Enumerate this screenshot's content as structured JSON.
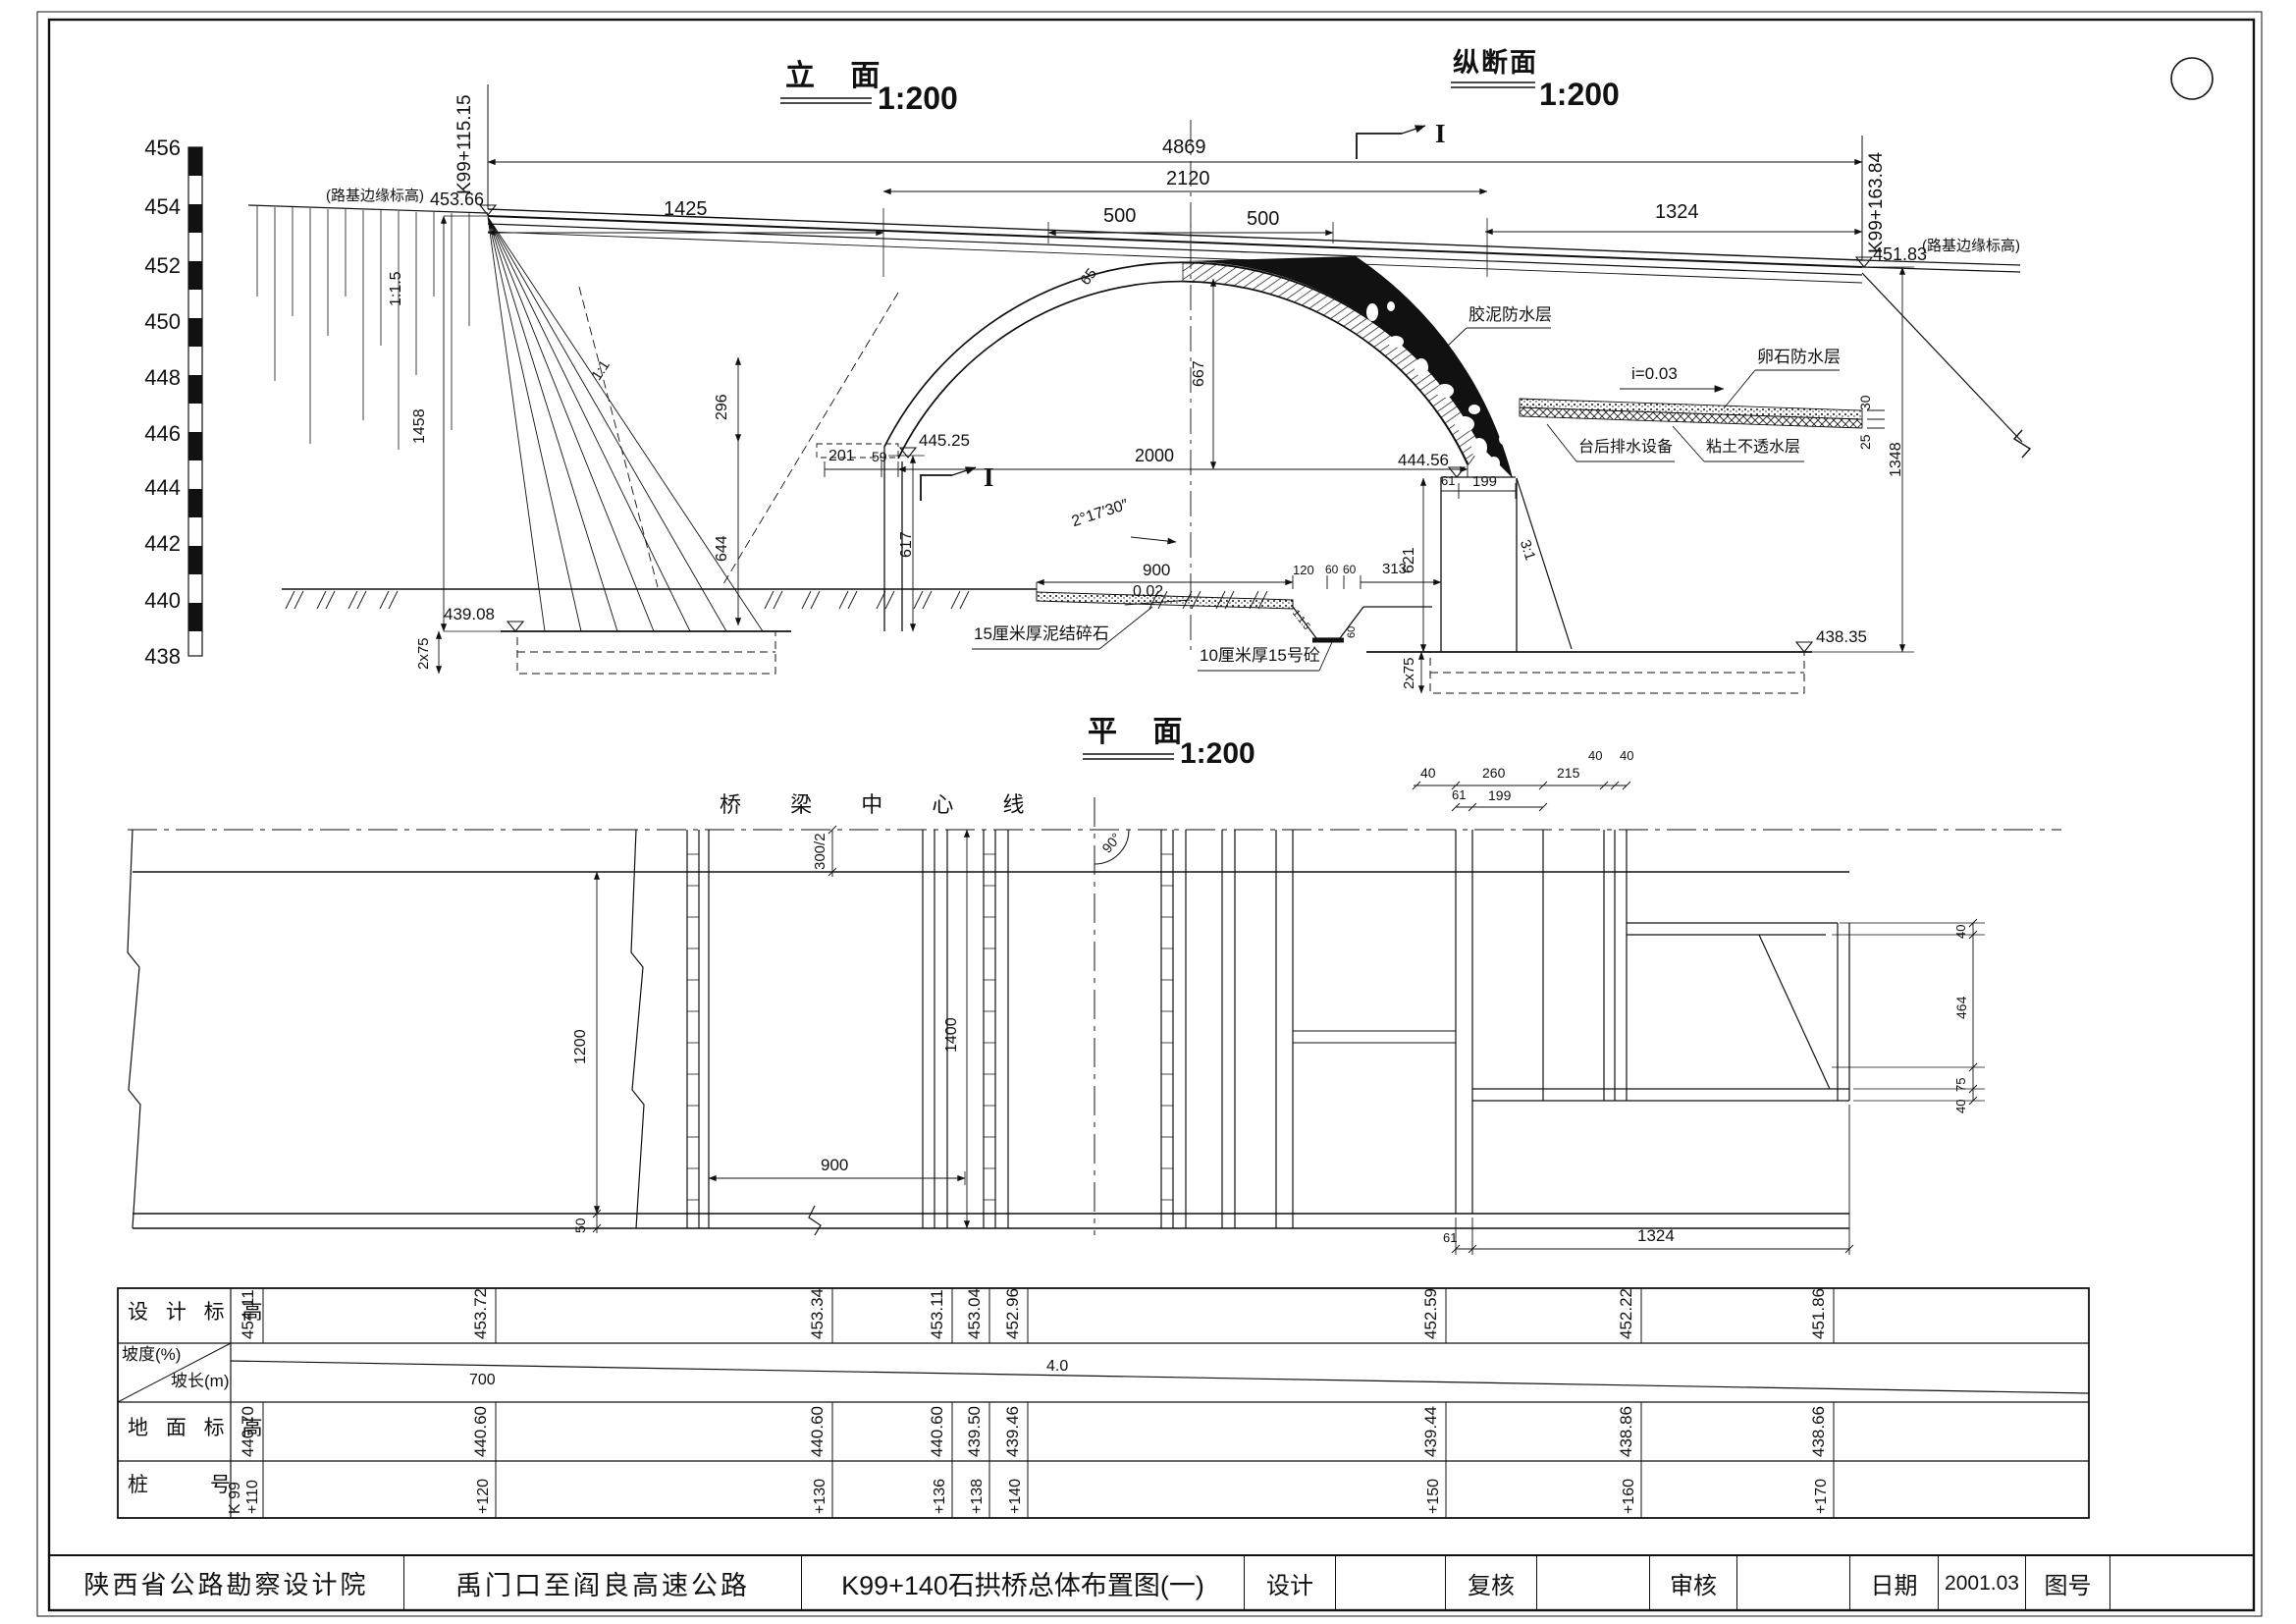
{
  "titles": {
    "elevation": "立  面",
    "elevation_scale": "1:200",
    "profile": "纵断面",
    "profile_scale": "1:200",
    "plan": "平  面",
    "plan_scale": "1:200",
    "section_top": "I",
    "section_bottom": "I"
  },
  "axis": [
    "456",
    "454",
    "452",
    "450",
    "448",
    "446",
    "444",
    "442",
    "440",
    "438"
  ],
  "elev": {
    "left_edge_note": "(路基边缘标高)",
    "left_edge_val": "453.66",
    "left_station": "K99+115.15",
    "right_station": "K99+163.84",
    "right_edge_val": "451.83",
    "right_edge_note": "(路基边缘标高)",
    "d4869": "4869",
    "d2120": "2120",
    "d1425": "1425",
    "d500a": "500",
    "d500b": "500",
    "d1324": "1324",
    "slope_115": "1:1.5",
    "slope_11": "1:1",
    "slope_31": "3:1",
    "d1458": "1458",
    "d296": "296",
    "d644": "644",
    "d201": "201",
    "d59": "59",
    "d617": "617",
    "d621": "621",
    "d667": "667",
    "d65": "65",
    "d2000": "2000",
    "elev_44525": "445.25",
    "elev_44456": "444.56",
    "elev_43908": "439.08",
    "elev_43835": "438.35",
    "angle": "2°17′30″",
    "d61": "61",
    "d199": "199",
    "d900": "900",
    "grade002": "0.02",
    "d120": "120",
    "d60a": "60",
    "d60b": "60",
    "d313": "313",
    "d2x75l": "2x75",
    "d2x75r": "2x75",
    "d1348": "1348",
    "d30": "30",
    "d25": "25",
    "ditch_slope": "1:1.5",
    "ditch_d60": "60",
    "lbl_jiaoni": "胶泥防水层",
    "lbl_luanshi": "卵石防水层",
    "lbl_i003": "i=0.03",
    "lbl_taihou": "台后排水设备",
    "lbl_niantu": "粘土不透水层",
    "note_macadam": "15厘米厚泥结碎石",
    "note_concrete": "10厘米厚15号砼"
  },
  "plan": {
    "centerline": "桥 梁 中 心 线",
    "angle90": "90°",
    "d300_2": "300/2",
    "d1200": "1200",
    "d50": "50",
    "d1400": "1400",
    "d900": "900",
    "d40a": "40",
    "d260": "260",
    "d215": "215",
    "d40b": "40",
    "d40c": "40",
    "d61a": "61",
    "d199": "199",
    "d40d": "40",
    "d464": "464",
    "d75": "75",
    "d40e": "40",
    "d61b": "61",
    "d1324": "1324"
  },
  "table": {
    "design_label": "设 计 标 高",
    "slope_label": "坡度(%)",
    "slope_len_label": "坡长(m)",
    "ground_label": "地 面 标 高",
    "station_label": "桩　　　号",
    "station_prefix": "K 99",
    "stations": [
      "+110",
      "+120",
      "+130",
      "+136",
      "+138",
      "+140",
      "+150",
      "+160",
      "+170"
    ],
    "design": [
      "454.11",
      "453.72",
      "453.34",
      "453.11",
      "453.04",
      "452.96",
      "452.59",
      "452.22",
      "451.86"
    ],
    "ground": [
      "440.70",
      "440.60",
      "440.60",
      "440.60",
      "439.50",
      "439.46",
      "439.44",
      "438.86",
      "438.66"
    ],
    "slope_len": "700",
    "grade": "4.0"
  },
  "block": {
    "org": "陕西省公路勘察设计院",
    "project": "禹门口至阎良高速公路",
    "drawing_title": "K99+140石拱桥总体布置图(一)",
    "design": "设计",
    "check": "复核",
    "review": "审核",
    "date": "日期",
    "date_val": "2001.03",
    "fig": "图号"
  }
}
